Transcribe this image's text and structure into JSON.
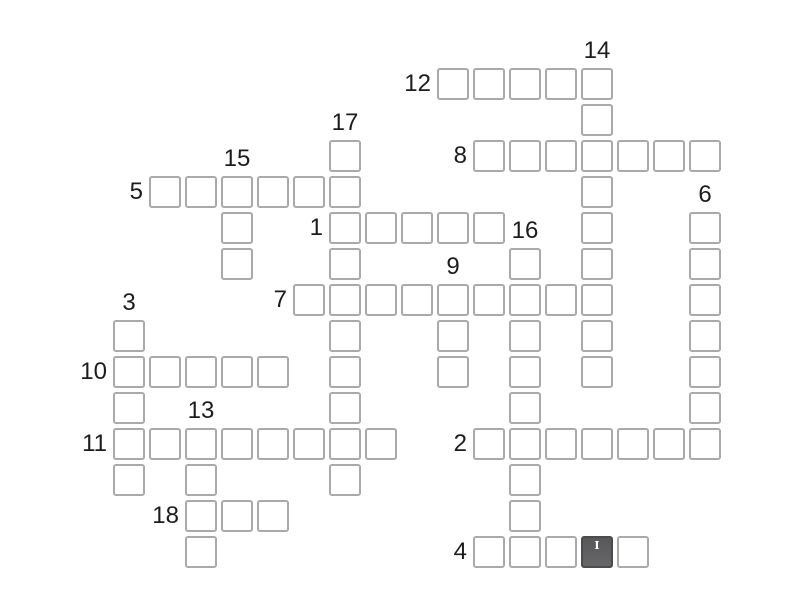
{
  "app": {
    "name": "crossword-puzzle"
  },
  "colors": {
    "background": "#ffffff",
    "cell_border": "#a9a9a9",
    "cell_fill": "#ffffff",
    "selected_cell_top": "#58585a",
    "selected_cell_bottom": "#666668",
    "selected_cell_border": "#4c4c4e",
    "cursor": "#ffffff",
    "number_text": "#1c1c1c"
  },
  "grid": {
    "origin_x": 113,
    "origin_y": 68,
    "cell_size": 32,
    "pitch": 36,
    "columns": 17,
    "rows": 14
  },
  "selected_cell": {
    "col": 13,
    "row": 13
  },
  "cursor_icon": "I",
  "words": [
    {
      "number": "12",
      "direction": "across",
      "col": 9,
      "row": 0,
      "length": 5
    },
    {
      "number": "14",
      "direction": "down",
      "col": 13,
      "row": 0,
      "length": 9
    },
    {
      "number": "8",
      "direction": "across",
      "col": 10,
      "row": 2,
      "length": 7
    },
    {
      "number": "17",
      "direction": "down",
      "col": 6,
      "row": 2,
      "length": 10
    },
    {
      "number": "5",
      "direction": "across",
      "col": 1,
      "row": 3,
      "length": 6
    },
    {
      "number": "15",
      "direction": "down",
      "col": 3,
      "row": 3,
      "length": 3
    },
    {
      "number": "1",
      "direction": "across",
      "col": 6,
      "row": 4,
      "length": 5
    },
    {
      "number": "6",
      "direction": "down",
      "col": 16,
      "row": 4,
      "length": 7
    },
    {
      "number": "16",
      "direction": "down",
      "col": 11,
      "row": 5,
      "length": 9
    },
    {
      "number": "7",
      "direction": "across",
      "col": 5,
      "row": 6,
      "length": 9
    },
    {
      "number": "9",
      "direction": "down",
      "col": 9,
      "row": 6,
      "length": 3
    },
    {
      "number": "3",
      "direction": "down",
      "col": 0,
      "row": 7,
      "length": 5
    },
    {
      "number": "10",
      "direction": "across",
      "col": 0,
      "row": 8,
      "length": 5
    },
    {
      "number": "13",
      "direction": "down",
      "col": 2,
      "row": 10,
      "length": 4
    },
    {
      "number": "11",
      "direction": "across",
      "col": 0,
      "row": 10,
      "length": 8
    },
    {
      "number": "2",
      "direction": "across",
      "col": 10,
      "row": 10,
      "length": 7
    },
    {
      "number": "18",
      "direction": "across",
      "col": 2,
      "row": 12,
      "length": 3
    },
    {
      "number": "4",
      "direction": "across",
      "col": 10,
      "row": 13,
      "length": 5
    }
  ]
}
